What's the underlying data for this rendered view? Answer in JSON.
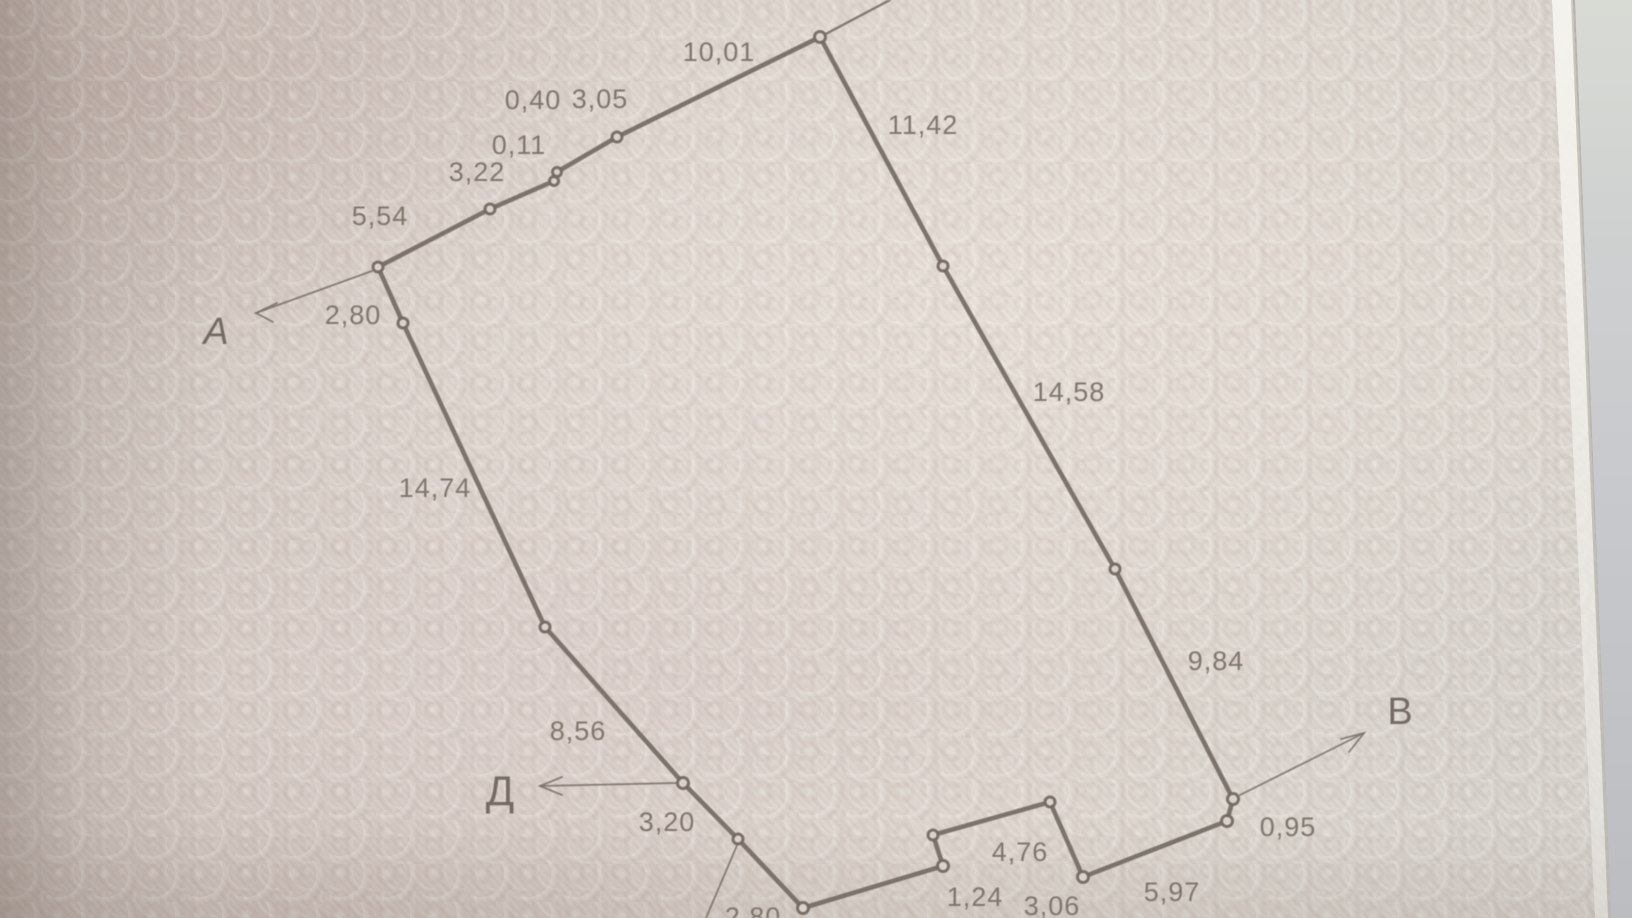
{
  "palette": {
    "paper": "#d8d0c9",
    "paper_light": "#e6dfd7",
    "ink_line": "#746b64",
    "label_text": "#7b7269",
    "under_page": "#c4c6ca"
  },
  "diagram": {
    "description": "hand-plotted land parcel boundary sketch with measured side lengths (meters)",
    "reference_points": [
      {
        "label": "А"
      },
      {
        "label": "Д"
      },
      {
        "label": "В"
      }
    ],
    "edge_labels": [
      {
        "id": "e-top",
        "text": "10,01"
      },
      {
        "id": "e-040",
        "text": "0,40"
      },
      {
        "id": "e-305",
        "text": "3,05"
      },
      {
        "id": "e-011",
        "text": "0,11"
      },
      {
        "id": "e-322",
        "text": "3,22"
      },
      {
        "id": "e-554",
        "text": "5,54"
      },
      {
        "id": "e-280-left",
        "text": "2,80"
      },
      {
        "id": "e-1474",
        "text": "14,74"
      },
      {
        "id": "e-856",
        "text": "8,56"
      },
      {
        "id": "e-320",
        "text": "3,20"
      },
      {
        "id": "e-1142",
        "text": "11,42"
      },
      {
        "id": "e-1458",
        "text": "14,58"
      },
      {
        "id": "e-984",
        "text": "9,84"
      },
      {
        "id": "e-095",
        "text": "0,95"
      },
      {
        "id": "e-597",
        "text": "5,97"
      },
      {
        "id": "e-476",
        "text": "4,76"
      },
      {
        "id": "e-124",
        "text": "1,24"
      },
      {
        "id": "e-306",
        "text": "3,06"
      },
      {
        "id": "e-280-bottom",
        "text": "2,80"
      }
    ]
  }
}
